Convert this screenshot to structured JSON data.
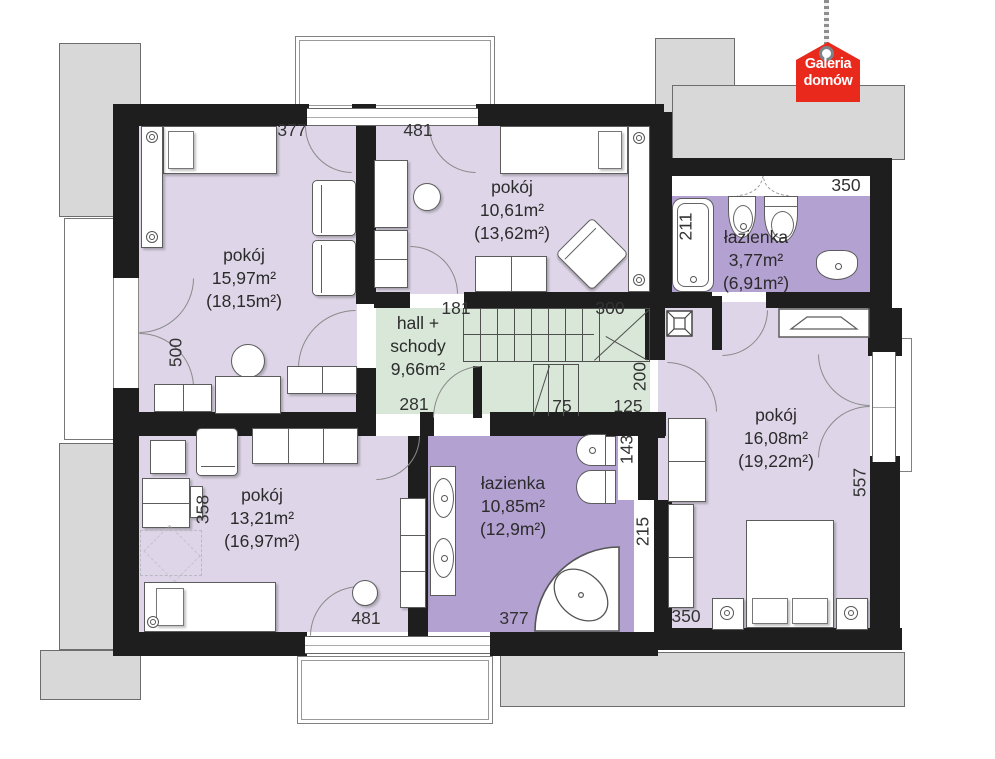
{
  "logo": {
    "line1": "Galeria",
    "line2": "domów"
  },
  "rooms": {
    "pokoj1": {
      "name": "pokój",
      "area": "15,97m²",
      "area_gross": "(18,15m²)"
    },
    "pokoj2": {
      "name": "pokój",
      "area": "10,61m²",
      "area_gross": "(13,62m²)"
    },
    "lazienka1": {
      "name": "łazienka",
      "area": "3,77m²",
      "area_gross": "(6,91m²)"
    },
    "hall": {
      "name_line1": "hall +",
      "name_line2": "schody",
      "area": "9,66m²"
    },
    "pokoj3": {
      "name": "pokój",
      "area": "13,21m²",
      "area_gross": "(16,97m²)"
    },
    "lazienka2": {
      "name": "łazienka",
      "area": "10,85m²",
      "area_gross": "(12,9m²)"
    },
    "pokoj4": {
      "name": "pokój",
      "area": "16,08m²",
      "area_gross": "(19,22m²)"
    }
  },
  "dimensions": {
    "top_left": "377",
    "top_mid": "481",
    "top_right": "350",
    "bath1_tub": "211",
    "left_door": "500",
    "hall_top": "181",
    "stairs_run": "300",
    "hall_bottom": "281",
    "stairs_lower": "75",
    "stairs_landing": "125",
    "stairs_height": "200",
    "room3_side": "358",
    "bottom_left": "481",
    "bath2_bottom": "377",
    "bath2_right_upper": "143",
    "bath2_right_lower": "215",
    "room4_bottom": "350",
    "room4_right": "557"
  },
  "colors": {
    "wall": "#1e1e1e",
    "room_fill": "#ded6e8",
    "bath_fill": "#b3a1d1",
    "hall_fill": "#d9e7d8",
    "roof": "#d8d8d8",
    "logo_red": "#e8291c"
  }
}
